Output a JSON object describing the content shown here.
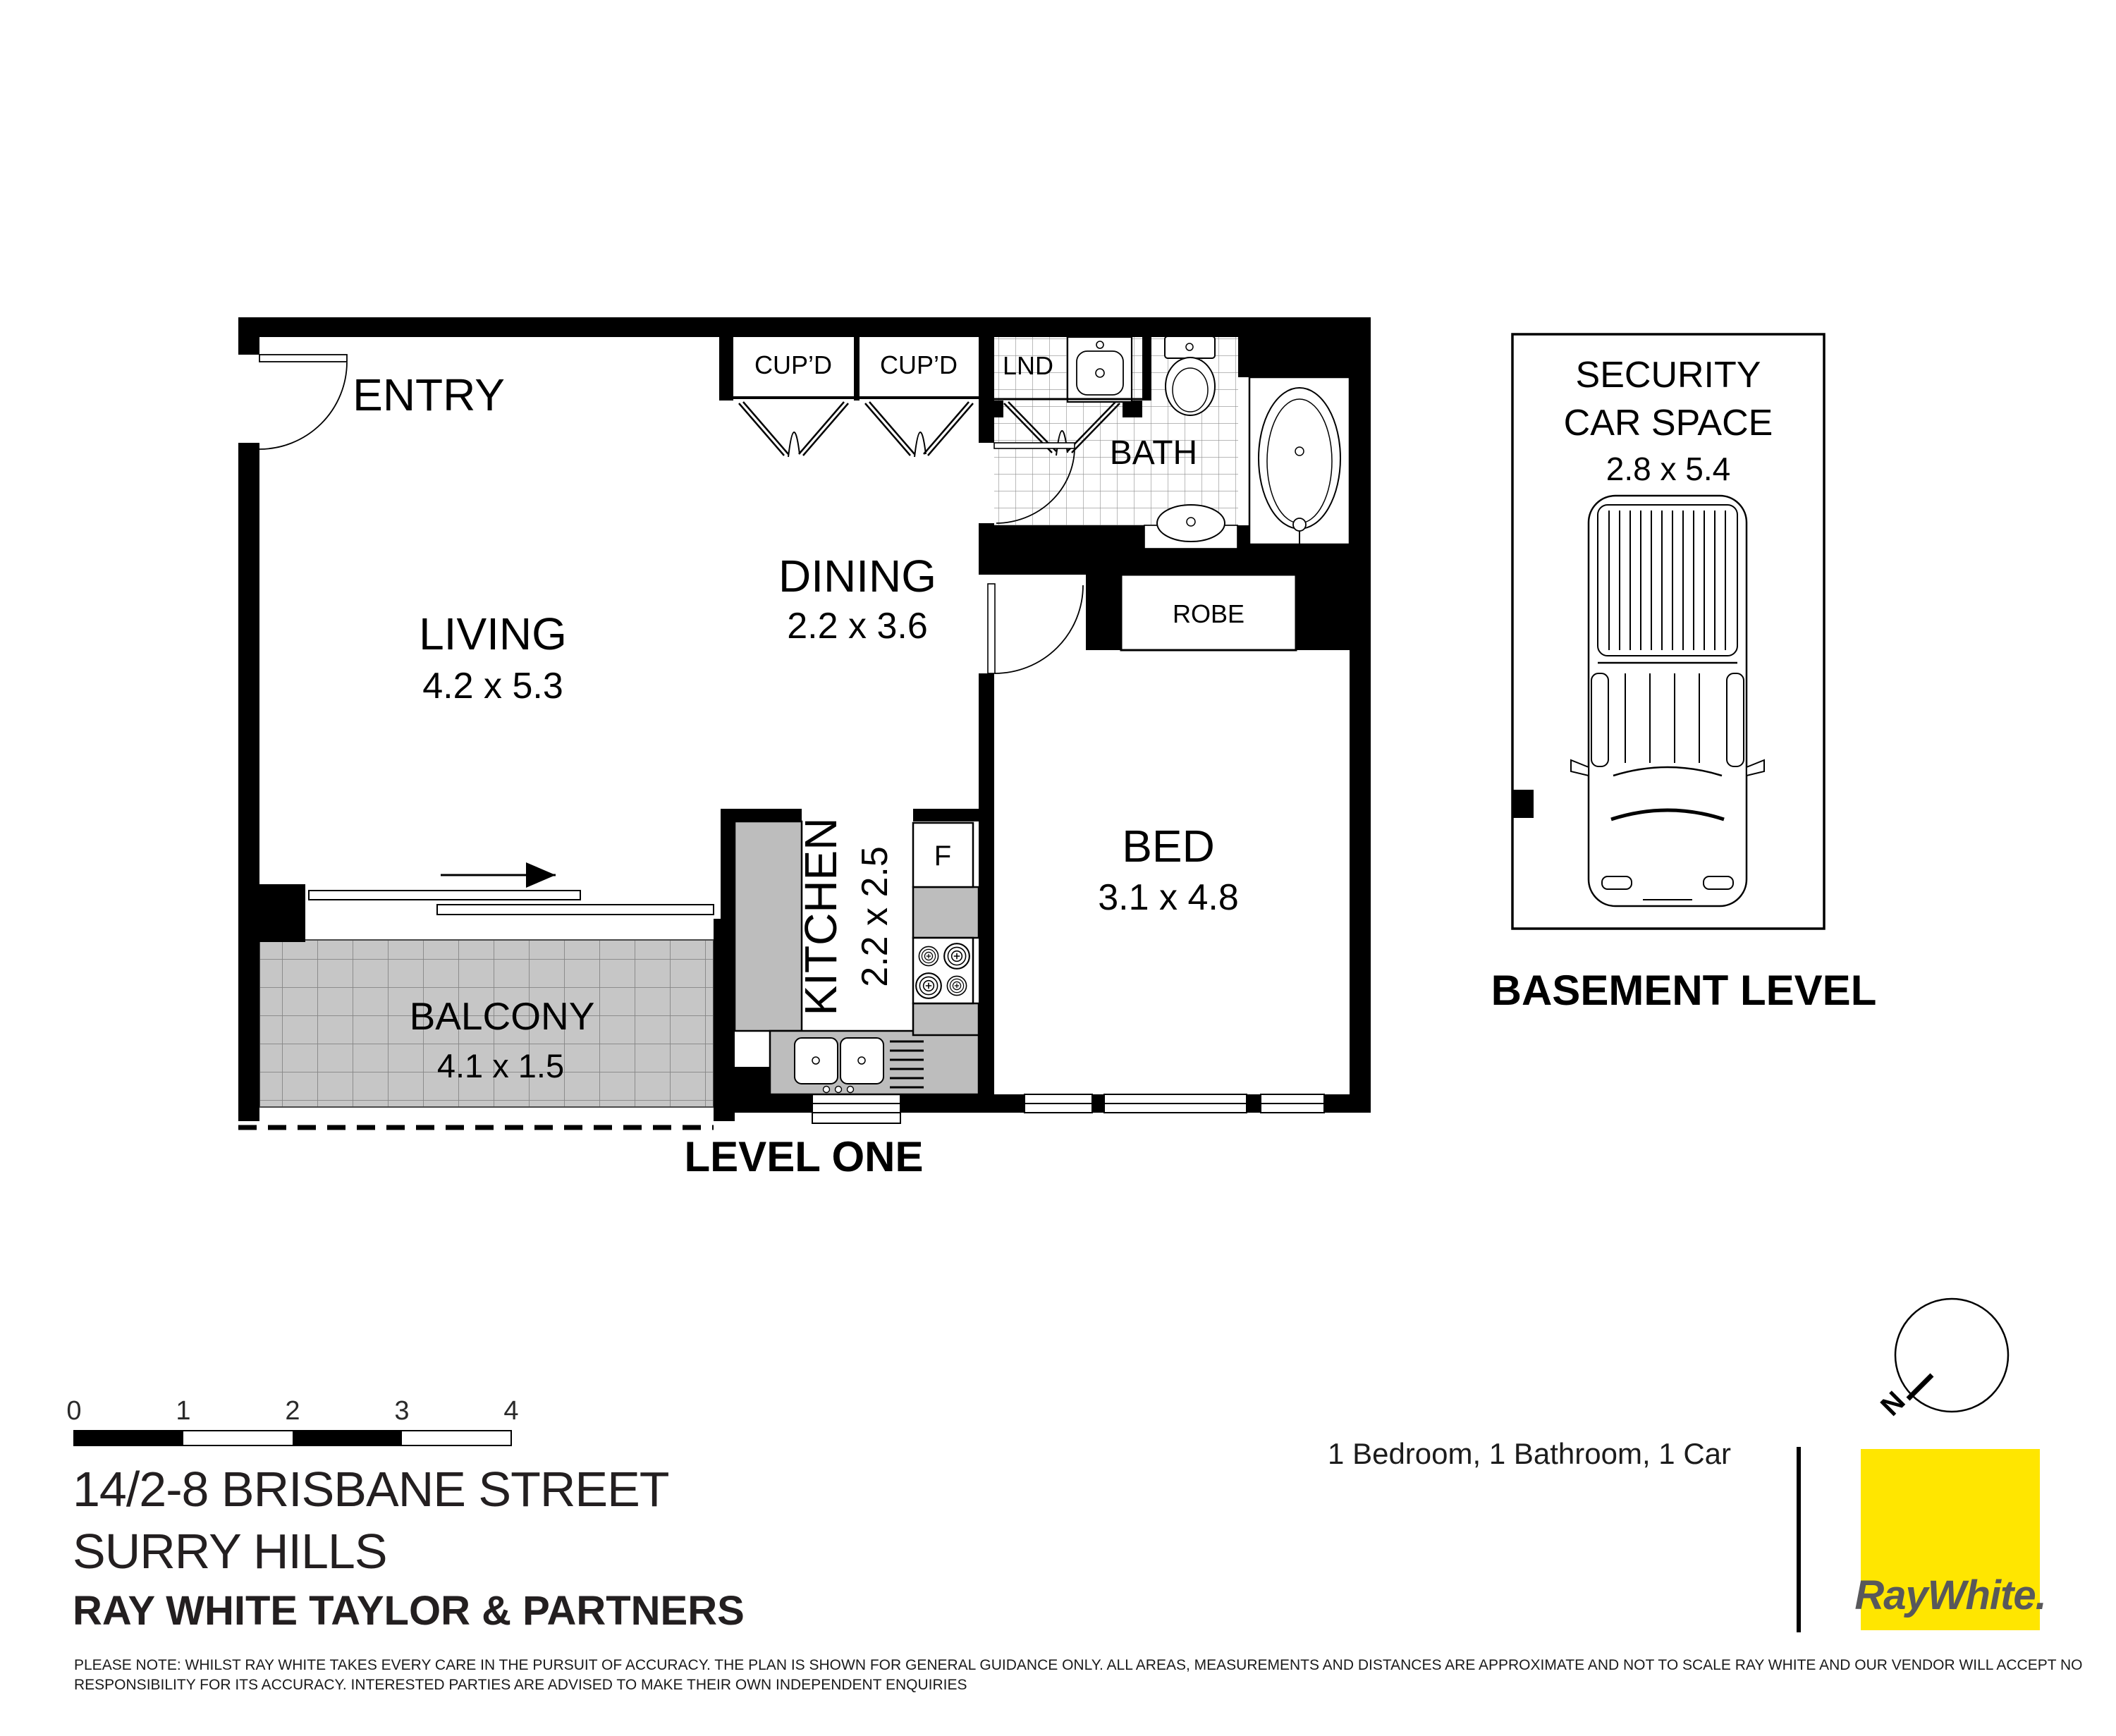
{
  "colors": {
    "brand_yellow": "#FFE600",
    "brand_gray": "#58585B",
    "balcony_tile": "#C6C6C6",
    "counter_gray": "#BDBDBD"
  },
  "floor_plan": {
    "level_label": "LEVEL ONE",
    "entry": {
      "label": "ENTRY"
    },
    "living": {
      "label": "LIVING",
      "dims": "4.2 x 5.3"
    },
    "dining": {
      "label": "DINING",
      "dims": "2.2 x 3.6"
    },
    "kitchen": {
      "label": "KITCHEN",
      "dims": "2.2 x 2.5",
      "fridge_label": "F"
    },
    "bed": {
      "label": "BED",
      "dims": "3.1 x 4.8"
    },
    "bath": {
      "label": "BATH"
    },
    "laundry": {
      "label": "LND"
    },
    "robe": {
      "label": "ROBE"
    },
    "balcony": {
      "label": "BALCONY",
      "dims": "4.1 x 1.5"
    },
    "cupboard_left": {
      "label": "CUP’D"
    },
    "cupboard_right": {
      "label": "CUP’D"
    }
  },
  "basement": {
    "level_label": "BASEMENT LEVEL",
    "car_space": {
      "line1": "SECURITY",
      "line2": "CAR SPACE",
      "dims": "2.8 x 5.4"
    }
  },
  "compass": {
    "north_label": "N"
  },
  "scale_bar": {
    "ticks": [
      "0",
      "1",
      "2",
      "3",
      "4"
    ]
  },
  "footer": {
    "address_line1": "14/2-8 BRISBANE STREET",
    "address_line2": "SURRY HILLS",
    "agency": "RAY WHITE TAYLOR & PARTNERS",
    "property_summary": "1 Bedroom, 1 Bathroom, 1 Car",
    "disclaimer_line1": "PLEASE NOTE: WHILST RAY WHITE TAKES EVERY CARE IN THE PURSUIT OF ACCURACY. THE PLAN IS SHOWN FOR GENERAL GUIDANCE ONLY. ALL AREAS, MEASUREMENTS AND DISTANCES ARE APPROXIMATE AND NOT TO SCALE RAY WHITE AND OUR VENDOR WILL ACCEPT NO",
    "disclaimer_line2": "RESPONSIBILITY FOR ITS ACCURACY. INTERESTED PARTIES ARE ADVISED TO MAKE THEIR OWN INDEPENDENT ENQUIRIES"
  },
  "logo": {
    "brand": "RayWhite."
  }
}
